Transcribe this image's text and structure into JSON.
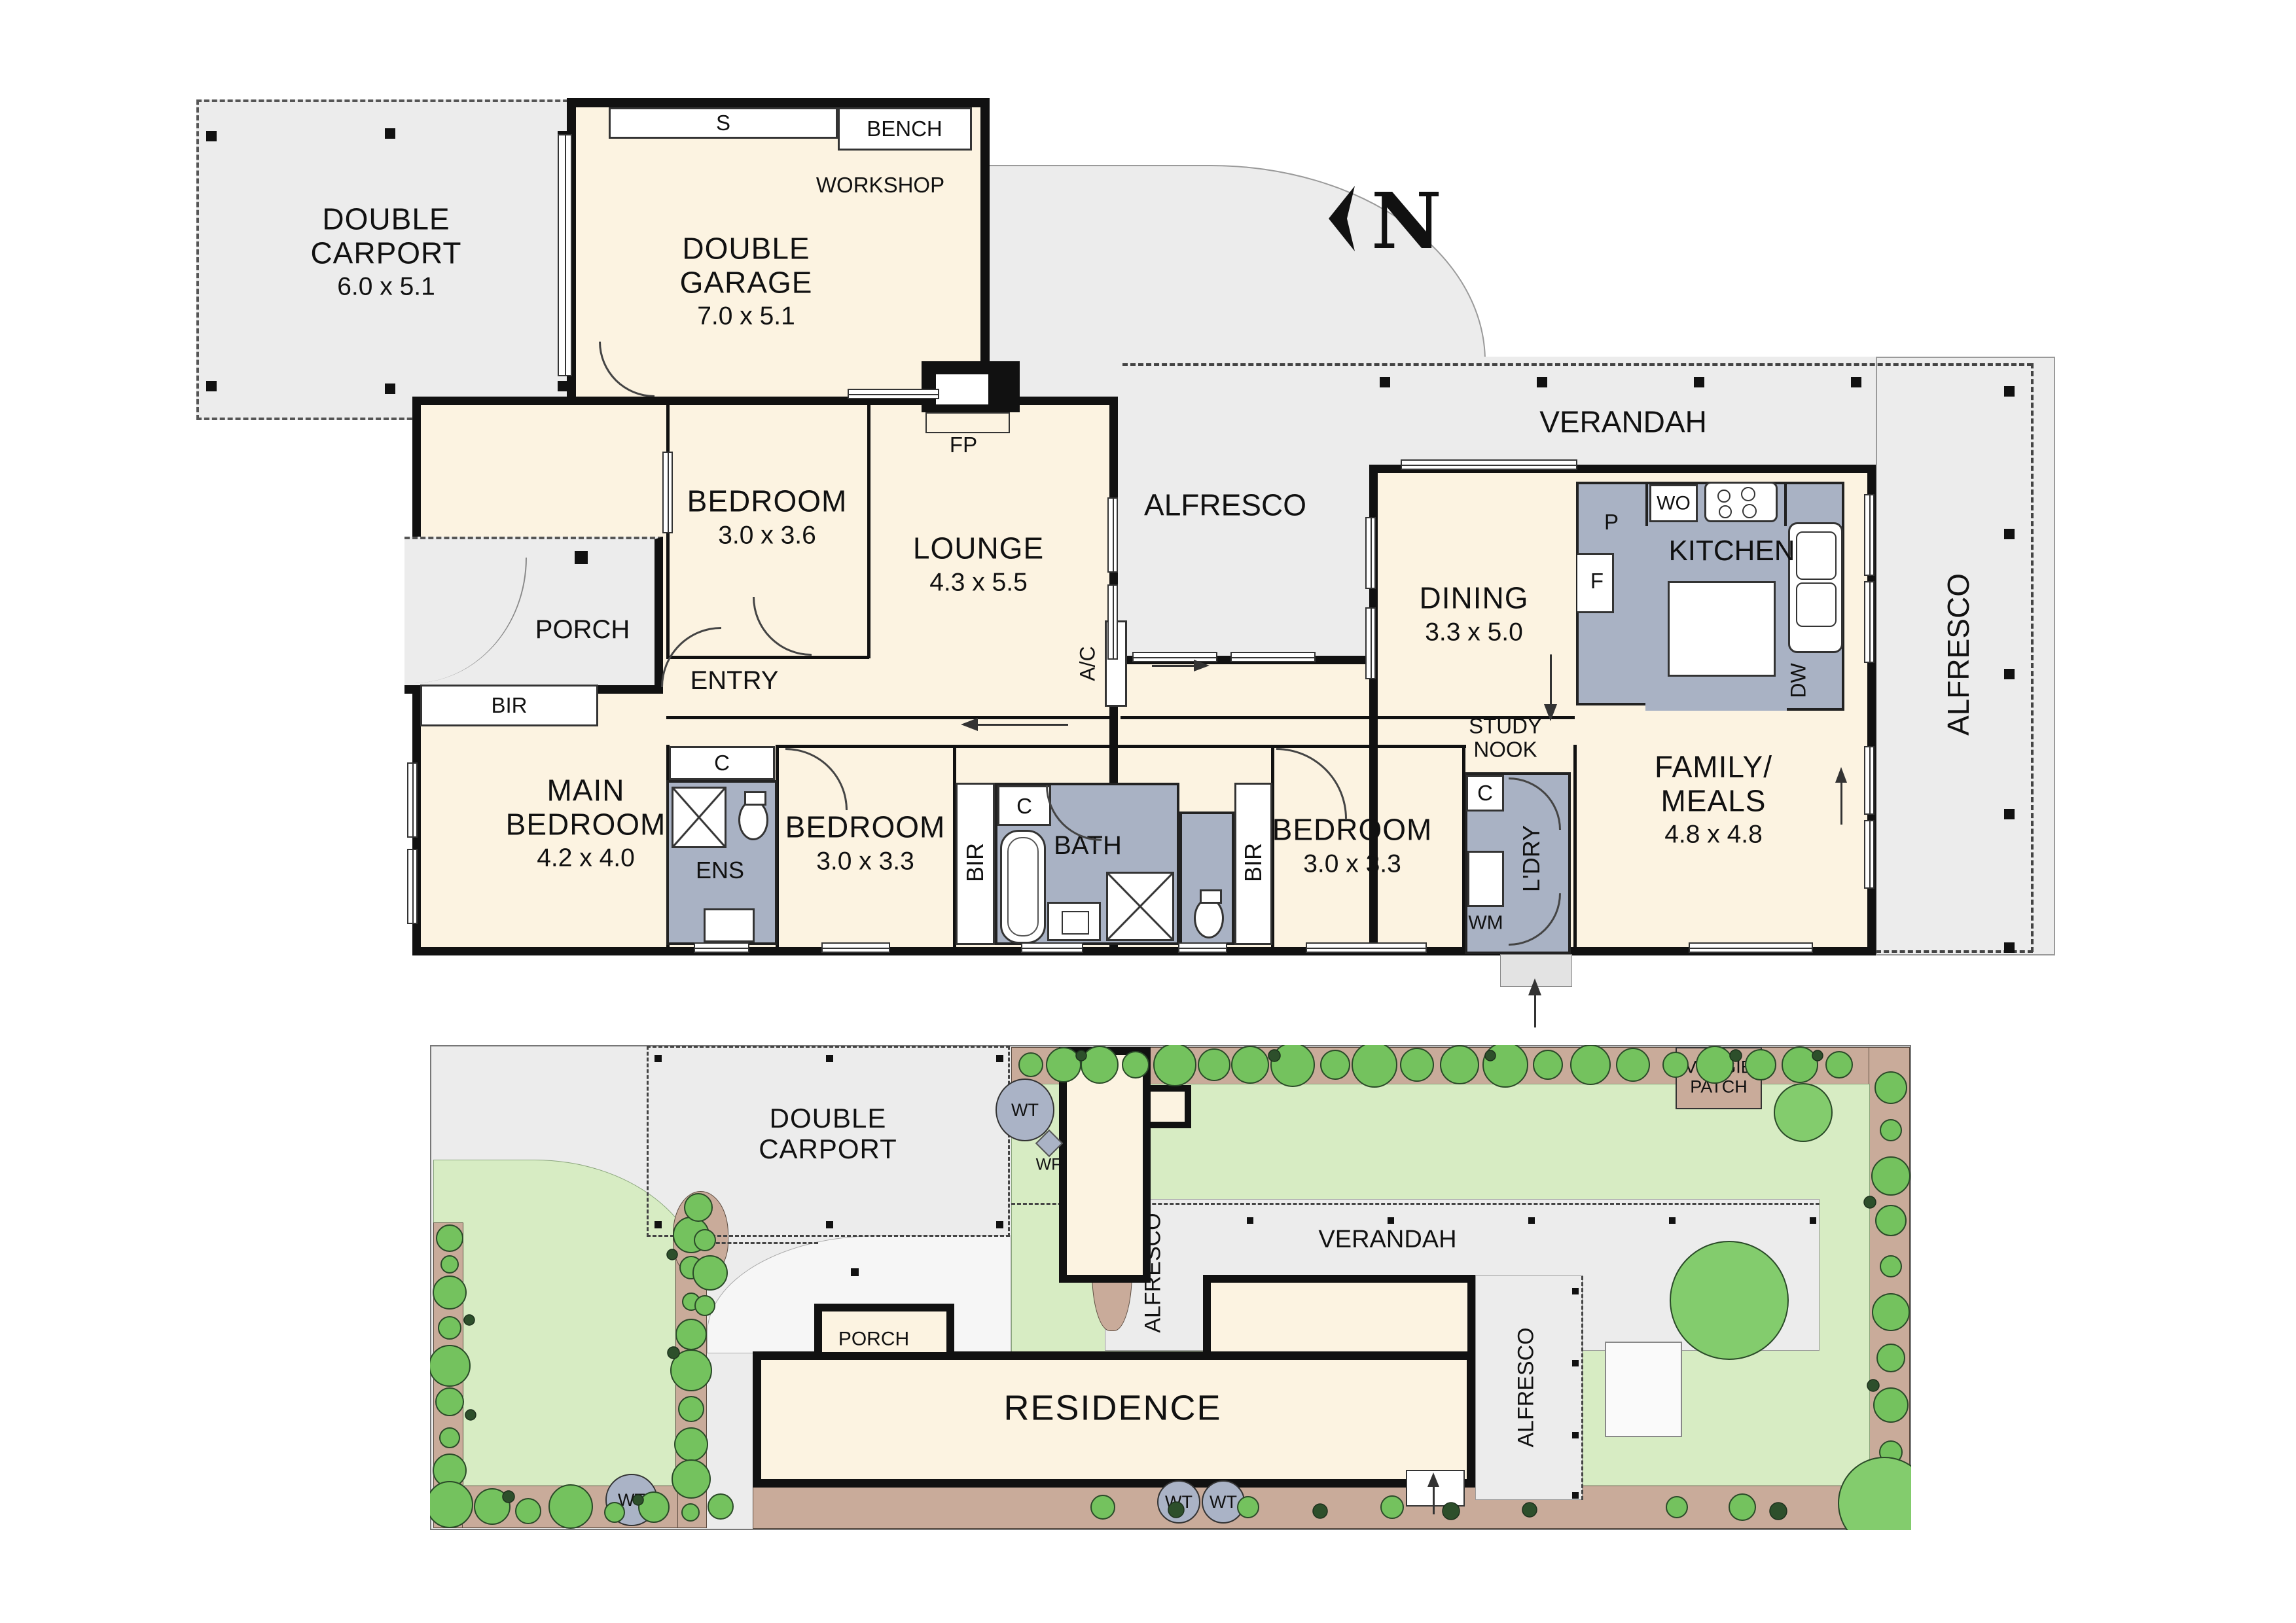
{
  "colors": {
    "wall": "#111111",
    "room_fill": "#fcf3e1",
    "outdoor_grey": "#ececec",
    "wet_area": "#a9b2c4",
    "lawn": "#d7ecc3",
    "garden_bed": "#c9ab9a",
    "tree": "#74c25e",
    "shrub": "#2d4f2b"
  },
  "floor_plan": {
    "carport": {
      "label": "DOUBLE\nCARPORT",
      "dims": "6.0 x 5.1"
    },
    "garage": {
      "label": "DOUBLE\nGARAGE",
      "dims": "7.0 x 5.1"
    },
    "storage": "S",
    "bench": "BENCH",
    "workshop": "WORKSHOP",
    "fp": "FP",
    "bedroom1": {
      "label": "BEDROOM",
      "dims": "3.0 x 3.6"
    },
    "lounge": {
      "label": "LOUNGE",
      "dims": "4.3 x 5.5"
    },
    "ac": "A/C",
    "verandah": "VERANDAH",
    "alfresco_mid": "ALFRESCO",
    "alfresco_right": "ALFRESCO",
    "porch": "PORCH",
    "entry": "ENTRY",
    "bir_main": "BIR",
    "bir_left": "BIR",
    "bir_right": "BIR",
    "main_bedroom": {
      "label": "MAIN\nBEDROOM",
      "dims": "4.2 x 4.0"
    },
    "ens": "ENS",
    "c_ens": "C",
    "c_bath": "C",
    "c_ldry": "C",
    "bedroom2": {
      "label": "BEDROOM",
      "dims": "3.0 x 3.3"
    },
    "bath": "BATH",
    "bedroom3": {
      "label": "BEDROOM",
      "dims": "3.0 x 3.3"
    },
    "study_nook": "STUDY\nNOOK",
    "ldry": "L'DRY",
    "wm": "WM",
    "family": {
      "label": "FAMILY/\nMEALS",
      "dims": "4.8 x 4.8"
    },
    "dining": {
      "label": "DINING",
      "dims": "3.3 x 5.0"
    },
    "kitchen": "KITCHEN",
    "wo": "WO",
    "p": "P",
    "f": "F",
    "dw": "DW",
    "compass": "N"
  },
  "site_plan": {
    "carport": "DOUBLE\nCARPORT",
    "porch": "PORCH",
    "residence": "RESIDENCE",
    "verandah": "VERANDAH",
    "alfresco_walk": "ALFRESCO",
    "alfresco_right": "ALFRESCO",
    "veggie_patch": "VEGGIE\nPATCH",
    "wt_top": "WT",
    "wt_left": "WT",
    "wt_a": "WT",
    "wt_b": "WT",
    "wf": "WF"
  }
}
